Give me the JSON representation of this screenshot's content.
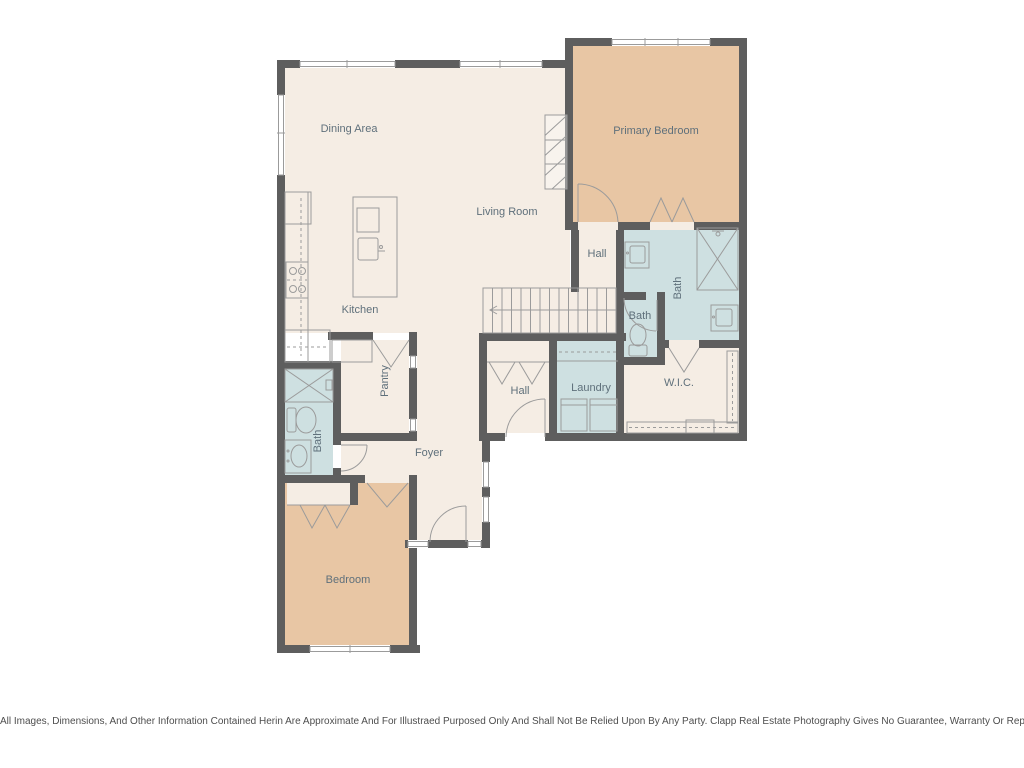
{
  "plan": {
    "rooms": {
      "dining_area": "Dining Area",
      "living_room": "Living Room",
      "primary_bedroom": "Primary Bedroom",
      "kitchen": "Kitchen",
      "hall_upper": "Hall",
      "primary_bath": "Bath",
      "toilet_room": "Bath",
      "laundry": "Laundry",
      "wic": "W.I.C.",
      "hall_lower": "Hall",
      "foyer": "Foyer",
      "pantry": "Pantry",
      "bath_lower": "Bath",
      "bedroom": "Bedroom"
    },
    "palette": {
      "wall": "#5e5e5e",
      "floor_cream": "#f5ede4",
      "floor_tan": "#e8c6a4",
      "floor_blue": "#cee0e1",
      "fixture_line": "#9b9b9b",
      "label_text": "#5f707b"
    }
  },
  "footer": {
    "disclaimer": "All Images, Dimensions, And Other Information Contained Herin Are Approximate And For Illustraed Purposed Only And Shall Not Be Relied Upon By Any Party. Clapp Real Estate Photography Gives No Guarantee, Warranty Or Representation As To The Accuracy Of This Information."
  }
}
